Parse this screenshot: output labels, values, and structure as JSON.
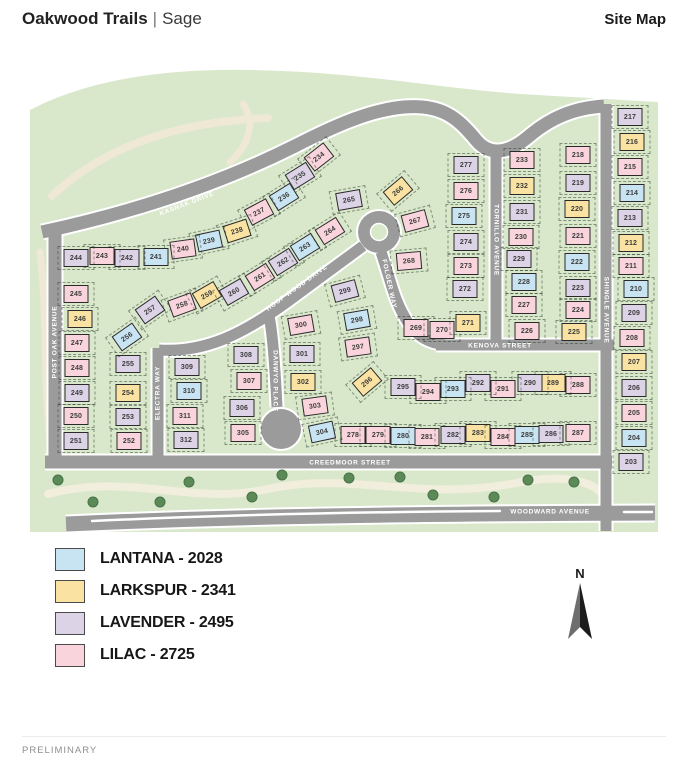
{
  "header": {
    "brand": "Oakwood Trails",
    "divider": "|",
    "subbrand": "Sage",
    "doc": "Site Map"
  },
  "footer": {
    "note": "PRELIMINARY"
  },
  "north": {
    "label": "N"
  },
  "plans": {
    "lantana": "#c8e3f1",
    "larkspur": "#fae3a2",
    "lavender": "#dcd3e6",
    "lilac": "#f9d4dd"
  },
  "legend": {
    "items": [
      {
        "plan": "lantana",
        "label": "LANTANA - 2028"
      },
      {
        "plan": "larkspur",
        "label": "LARKSPUR - 2341"
      },
      {
        "plan": "lavender",
        "label": "LAVENDER - 2495"
      },
      {
        "plan": "lilac",
        "label": "LILAC - 2725"
      }
    ]
  },
  "map": {
    "streets": [
      {
        "name": "KASNAK DRIVE",
        "x": 187,
        "y": 204,
        "r": -21
      },
      {
        "name": "POST OAK AVENUE",
        "x": 55,
        "y": 342,
        "r": -90
      },
      {
        "name": "HOOP WOOD DRIVE",
        "x": 297,
        "y": 288,
        "r": -36
      },
      {
        "name": "ELECTRA WAY",
        "x": 158,
        "y": 393,
        "r": -90
      },
      {
        "name": "DANWYO PLACE",
        "x": 275,
        "y": 381,
        "r": 90
      },
      {
        "name": "FOLGER WAY",
        "x": 389,
        "y": 284,
        "r": 78
      },
      {
        "name": "KENOVA STREET",
        "x": 500,
        "y": 346,
        "r": 0
      },
      {
        "name": "TORNILLO AVENUE",
        "x": 496,
        "y": 240,
        "r": 90
      },
      {
        "name": "SHINGLE AVENUE",
        "x": 606,
        "y": 310,
        "r": 90
      },
      {
        "name": "CREEDMOOR STREET",
        "x": 350,
        "y": 463,
        "r": 0
      },
      {
        "name": "WOODWARD AVENUE",
        "x": 550,
        "y": 512,
        "r": 0
      }
    ],
    "lots": [
      {
        "n": 203,
        "x": 631,
        "y": 462,
        "p": "lavender"
      },
      {
        "n": 204,
        "x": 634,
        "y": 438,
        "p": "lantana"
      },
      {
        "n": 205,
        "x": 634,
        "y": 413,
        "p": "lilac"
      },
      {
        "n": 206,
        "x": 634,
        "y": 388,
        "p": "lavender"
      },
      {
        "n": 207,
        "x": 634,
        "y": 362,
        "p": "larkspur"
      },
      {
        "n": 208,
        "x": 632,
        "y": 338,
        "p": "lilac"
      },
      {
        "n": 209,
        "x": 634,
        "y": 313,
        "p": "lavender"
      },
      {
        "n": 210,
        "x": 636,
        "y": 289,
        "p": "lantana"
      },
      {
        "n": 211,
        "x": 631,
        "y": 266,
        "p": "lilac"
      },
      {
        "n": 212,
        "x": 631,
        "y": 243,
        "p": "larkspur"
      },
      {
        "n": 213,
        "x": 630,
        "y": 218,
        "p": "lavender"
      },
      {
        "n": 214,
        "x": 632,
        "y": 193,
        "p": "lantana"
      },
      {
        "n": 215,
        "x": 630,
        "y": 167,
        "p": "lilac"
      },
      {
        "n": 216,
        "x": 632,
        "y": 142,
        "p": "larkspur"
      },
      {
        "n": 217,
        "x": 630,
        "y": 117,
        "p": "lavender"
      },
      {
        "n": 218,
        "x": 578,
        "y": 155,
        "p": "lilac"
      },
      {
        "n": 219,
        "x": 578,
        "y": 183,
        "p": "lavender"
      },
      {
        "n": 220,
        "x": 577,
        "y": 209,
        "p": "larkspur"
      },
      {
        "n": 221,
        "x": 578,
        "y": 236,
        "p": "lilac"
      },
      {
        "n": 222,
        "x": 577,
        "y": 262,
        "p": "lantana"
      },
      {
        "n": 223,
        "x": 578,
        "y": 288,
        "p": "lavender"
      },
      {
        "n": 224,
        "x": 578,
        "y": 310,
        "p": "lilac"
      },
      {
        "n": 225,
        "x": 574,
        "y": 332,
        "p": "larkspur"
      },
      {
        "n": 226,
        "x": 527,
        "y": 331,
        "p": "lilac"
      },
      {
        "n": 227,
        "x": 524,
        "y": 305,
        "p": "lilac"
      },
      {
        "n": 228,
        "x": 524,
        "y": 282,
        "p": "lantana"
      },
      {
        "n": 229,
        "x": 519,
        "y": 259,
        "p": "lavender"
      },
      {
        "n": 230,
        "x": 521,
        "y": 237,
        "p": "lilac"
      },
      {
        "n": 231,
        "x": 522,
        "y": 212,
        "p": "lavender"
      },
      {
        "n": 232,
        "x": 522,
        "y": 186,
        "p": "larkspur"
      },
      {
        "n": 233,
        "x": 522,
        "y": 160,
        "p": "lilac"
      },
      {
        "n": 234,
        "x": 319,
        "y": 157,
        "p": "lilac",
        "r": -38
      },
      {
        "n": 235,
        "x": 300,
        "y": 176,
        "p": "lavender",
        "r": -32
      },
      {
        "n": 236,
        "x": 284,
        "y": 197,
        "p": "lantana",
        "r": -32
      },
      {
        "n": 237,
        "x": 259,
        "y": 212,
        "p": "lilac",
        "r": -28
      },
      {
        "n": 238,
        "x": 237,
        "y": 231,
        "p": "larkspur",
        "r": -18
      },
      {
        "n": 239,
        "x": 209,
        "y": 241,
        "p": "lantana",
        "r": -12
      },
      {
        "n": 240,
        "x": 183,
        "y": 249,
        "p": "lilac",
        "r": -8
      },
      {
        "n": 241,
        "x": 156,
        "y": 257,
        "p": "lantana"
      },
      {
        "n": 242,
        "x": 127,
        "y": 258,
        "p": "lavender"
      },
      {
        "n": 243,
        "x": 102,
        "y": 256,
        "p": "lilac"
      },
      {
        "n": 244,
        "x": 76,
        "y": 258,
        "p": "lavender"
      },
      {
        "n": 245,
        "x": 76,
        "y": 294,
        "p": "lilac"
      },
      {
        "n": 246,
        "x": 80,
        "y": 319,
        "p": "larkspur"
      },
      {
        "n": 247,
        "x": 77,
        "y": 343,
        "p": "lilac"
      },
      {
        "n": 248,
        "x": 77,
        "y": 368,
        "p": "lilac"
      },
      {
        "n": 249,
        "x": 77,
        "y": 393,
        "p": "lavender"
      },
      {
        "n": 250,
        "x": 76,
        "y": 416,
        "p": "lilac"
      },
      {
        "n": 251,
        "x": 76,
        "y": 441,
        "p": "lavender"
      },
      {
        "n": 252,
        "x": 129,
        "y": 441,
        "p": "lilac"
      },
      {
        "n": 253,
        "x": 128,
        "y": 417,
        "p": "lavender"
      },
      {
        "n": 254,
        "x": 128,
        "y": 393,
        "p": "larkspur"
      },
      {
        "n": 255,
        "x": 128,
        "y": 364,
        "p": "lavender"
      },
      {
        "n": 256,
        "x": 127,
        "y": 337,
        "p": "lantana",
        "r": -35
      },
      {
        "n": 257,
        "x": 150,
        "y": 310,
        "p": "lavender",
        "r": -35
      },
      {
        "n": 258,
        "x": 182,
        "y": 305,
        "p": "lilac",
        "r": -20
      },
      {
        "n": 259,
        "x": 207,
        "y": 295,
        "p": "larkspur",
        "r": -30
      },
      {
        "n": 260,
        "x": 234,
        "y": 292,
        "p": "lavender",
        "r": -30
      },
      {
        "n": 261,
        "x": 260,
        "y": 277,
        "p": "lilac",
        "r": -32
      },
      {
        "n": 262,
        "x": 283,
        "y": 262,
        "p": "lavender",
        "r": -32
      },
      {
        "n": 263,
        "x": 305,
        "y": 247,
        "p": "lantana",
        "r": -32
      },
      {
        "n": 264,
        "x": 330,
        "y": 231,
        "p": "lilac",
        "r": -32
      },
      {
        "n": 265,
        "x": 349,
        "y": 200,
        "p": "lavender",
        "r": -10
      },
      {
        "n": 266,
        "x": 398,
        "y": 191,
        "p": "larkspur",
        "r": -40
      },
      {
        "n": 267,
        "x": 415,
        "y": 221,
        "p": "lilac",
        "r": -15
      },
      {
        "n": 268,
        "x": 409,
        "y": 261,
        "p": "lilac",
        "r": -5
      },
      {
        "n": 269,
        "x": 416,
        "y": 328,
        "p": "lilac"
      },
      {
        "n": 270,
        "x": 442,
        "y": 330,
        "p": "lilac"
      },
      {
        "n": 271,
        "x": 468,
        "y": 323,
        "p": "larkspur"
      },
      {
        "n": 272,
        "x": 465,
        "y": 289,
        "p": "lavender"
      },
      {
        "n": 273,
        "x": 466,
        "y": 266,
        "p": "lilac"
      },
      {
        "n": 274,
        "x": 466,
        "y": 242,
        "p": "lavender"
      },
      {
        "n": 275,
        "x": 464,
        "y": 216,
        "p": "lantana"
      },
      {
        "n": 276,
        "x": 466,
        "y": 191,
        "p": "lilac"
      },
      {
        "n": 277,
        "x": 466,
        "y": 165,
        "p": "lavender"
      },
      {
        "n": 278,
        "x": 353,
        "y": 435,
        "p": "lilac"
      },
      {
        "n": 279,
        "x": 378,
        "y": 435,
        "p": "lilac"
      },
      {
        "n": 280,
        "x": 403,
        "y": 436,
        "p": "lantana"
      },
      {
        "n": 281,
        "x": 427,
        "y": 437,
        "p": "lilac"
      },
      {
        "n": 282,
        "x": 453,
        "y": 435,
        "p": "lavender"
      },
      {
        "n": 283,
        "x": 478,
        "y": 433,
        "p": "larkspur"
      },
      {
        "n": 284,
        "x": 503,
        "y": 437,
        "p": "lilac"
      },
      {
        "n": 285,
        "x": 527,
        "y": 435,
        "p": "lantana"
      },
      {
        "n": 286,
        "x": 551,
        "y": 434,
        "p": "lavender"
      },
      {
        "n": 287,
        "x": 578,
        "y": 433,
        "p": "lilac"
      },
      {
        "n": 288,
        "x": 578,
        "y": 385,
        "p": "lilac"
      },
      {
        "n": 289,
        "x": 553,
        "y": 383,
        "p": "larkspur"
      },
      {
        "n": 290,
        "x": 530,
        "y": 383,
        "p": "lavender"
      },
      {
        "n": 291,
        "x": 503,
        "y": 389,
        "p": "lilac"
      },
      {
        "n": 292,
        "x": 478,
        "y": 383,
        "p": "lavender"
      },
      {
        "n": 293,
        "x": 453,
        "y": 389,
        "p": "lantana"
      },
      {
        "n": 294,
        "x": 428,
        "y": 392,
        "p": "lilac"
      },
      {
        "n": 295,
        "x": 403,
        "y": 387,
        "p": "lavender"
      },
      {
        "n": 296,
        "x": 367,
        "y": 382,
        "p": "larkspur",
        "r": -40
      },
      {
        "n": 297,
        "x": 358,
        "y": 347,
        "p": "lilac",
        "r": -8
      },
      {
        "n": 298,
        "x": 357,
        "y": 320,
        "p": "lantana",
        "r": -10
      },
      {
        "n": 299,
        "x": 345,
        "y": 291,
        "p": "lavender",
        "r": -15
      },
      {
        "n": 300,
        "x": 301,
        "y": 325,
        "p": "lilac",
        "r": -10
      },
      {
        "n": 301,
        "x": 302,
        "y": 354,
        "p": "lavender"
      },
      {
        "n": 302,
        "x": 303,
        "y": 382,
        "p": "larkspur"
      },
      {
        "n": 303,
        "x": 315,
        "y": 406,
        "p": "lilac",
        "r": -8
      },
      {
        "n": 304,
        "x": 322,
        "y": 432,
        "p": "lantana",
        "r": -12
      },
      {
        "n": 305,
        "x": 243,
        "y": 433,
        "p": "lilac"
      },
      {
        "n": 306,
        "x": 242,
        "y": 408,
        "p": "lavender"
      },
      {
        "n": 307,
        "x": 249,
        "y": 381,
        "p": "lilac"
      },
      {
        "n": 308,
        "x": 246,
        "y": 355,
        "p": "lavender"
      },
      {
        "n": 309,
        "x": 187,
        "y": 367,
        "p": "lavender"
      },
      {
        "n": 310,
        "x": 189,
        "y": 391,
        "p": "lantana"
      },
      {
        "n": 311,
        "x": 185,
        "y": 416,
        "p": "lilac"
      },
      {
        "n": 312,
        "x": 186,
        "y": 440,
        "p": "lavender"
      }
    ]
  }
}
